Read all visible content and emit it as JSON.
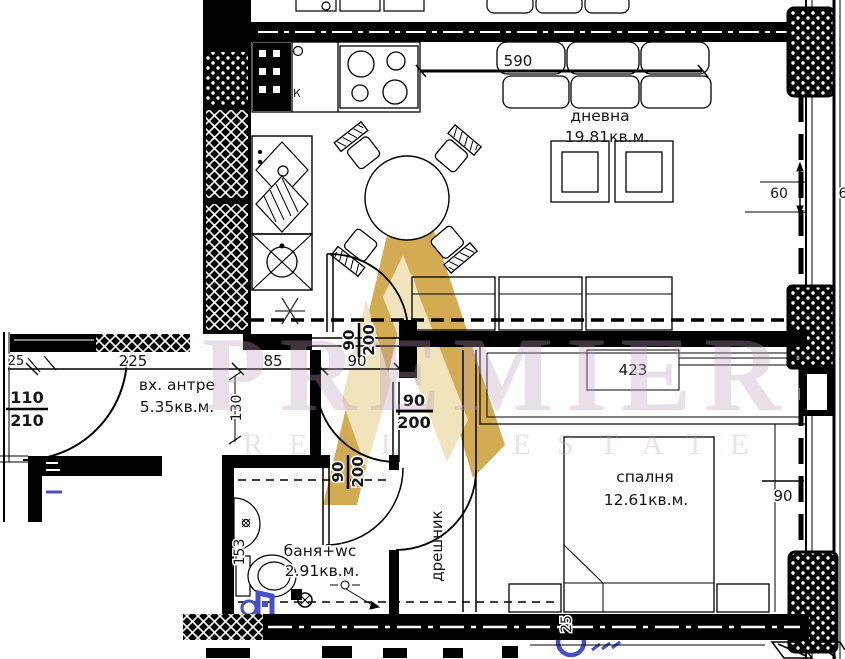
{
  "texts": {
    "living_name": "дневна",
    "living_area": "19.81кв.м.",
    "entry_name": "вх. антре",
    "entry_area": "5.35кв.м.",
    "bedroom_name": "спалня",
    "bedroom_area": "12.61кв.м.",
    "bath_name": "баня+wc",
    "bath_area": "2.91кв.м.",
    "closet_name": "дрешник",
    "k_label": "К"
  },
  "dims": {
    "w590": "590",
    "w60": "60",
    "w60_cut": "6",
    "w90_right": "90",
    "w25": "25",
    "w225": "225",
    "w85": "85",
    "w90_hall": "90",
    "w423": "423",
    "h130": "130",
    "h153": "153",
    "h25_bottom": "25",
    "door_entry_w": "110",
    "door_entry_h": "210",
    "door_w": "90",
    "door_h": "200"
  },
  "watermark": {
    "brand": "PREMIER",
    "tagline": "REAL ESTATE"
  },
  "colors": {
    "line": "#000000",
    "blue": "#4450c8",
    "gold": "#c9992e",
    "gold_light": "#eedfae",
    "wm_text": "rgba(187,158,187,0.33)"
  }
}
